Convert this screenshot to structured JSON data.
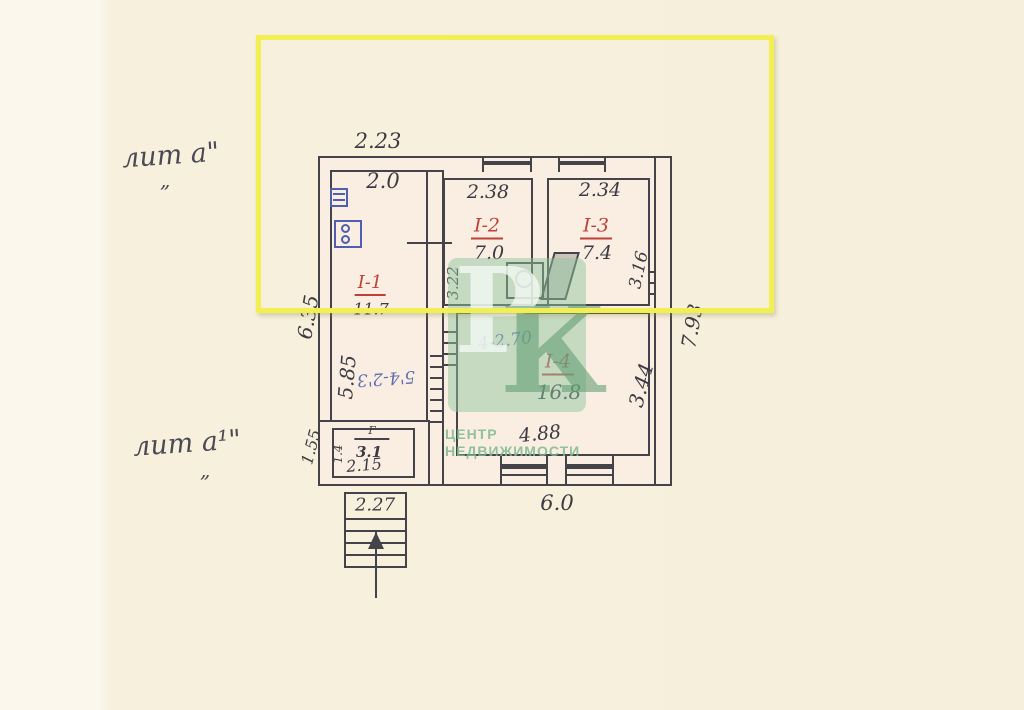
{
  "plan": {
    "building_labels": {
      "lit_a": "лит а\"",
      "lit_a_mark": "„",
      "lit_a1": "лит а¹\"",
      "lit_a1_mark": "„"
    },
    "rooms": {
      "r1": {
        "label": "I-1",
        "area": "11.7",
        "width": "2.0",
        "height": "5.85"
      },
      "r2": {
        "label": "I-2",
        "area": "7.0",
        "width": "2.38",
        "height": "3.22"
      },
      "r3": {
        "label": "I-3",
        "area": "7.4",
        "width": "2.34",
        "height": "3.16"
      },
      "r4": {
        "label": "I-4",
        "area": "16.8",
        "width": "4.88",
        "height": "3.44"
      },
      "annex": {
        "label": "Г",
        "area": "3.1",
        "width": "2.15",
        "height": "1.4"
      }
    },
    "outer_dims": {
      "top": "2.23",
      "left": "6.35",
      "left_annex": "1.55",
      "bottom": "6.0",
      "right": "7.93",
      "porch": "2.27"
    },
    "notes": {
      "blue_note": "4-2.70",
      "red_blue_note": "5'4-2'3"
    },
    "colors": {
      "pencil": "#45434a",
      "room_red": "#bf4038",
      "note_blue": "#4f5fae",
      "paper": "#f7f0dd",
      "highlight_yellow": "#f2ef52",
      "watermark_green": "#8dc59f"
    }
  },
  "watermark": {
    "letter_p": "Р",
    "letter_k": "К",
    "line1": "ЦЕНТР",
    "line2": "НЕДВИЖИМОСТИ"
  }
}
